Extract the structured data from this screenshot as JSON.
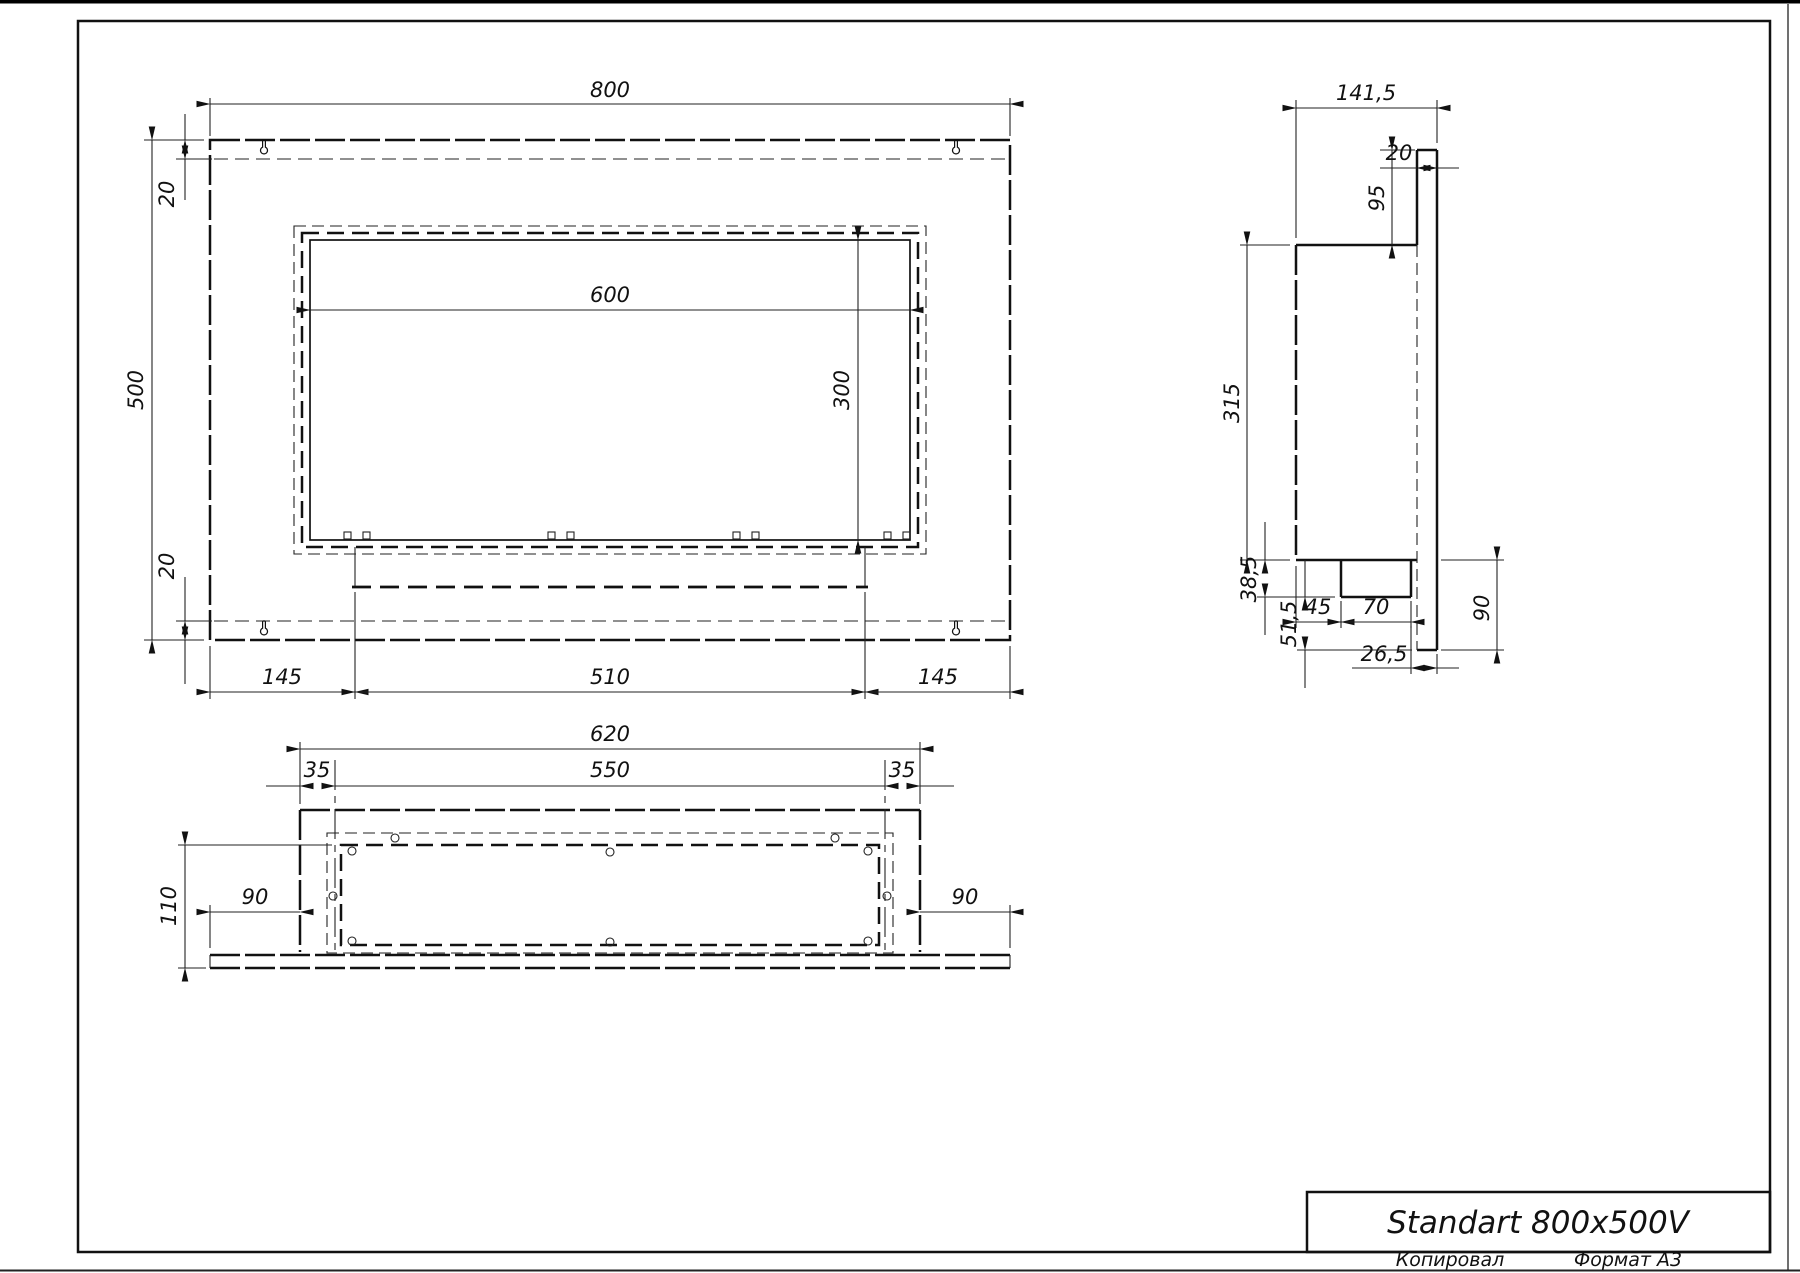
{
  "title_block": {
    "name": "Standart 800x500V"
  },
  "footer": {
    "copied": "Копировал",
    "format": "Формат А3"
  },
  "front_view": {
    "width": "800",
    "height": "500",
    "margin_top": "20",
    "margin_bottom": "20",
    "opening_width": "600",
    "opening_height": "300",
    "bottom_left": "145",
    "bottom_mid": "510",
    "bottom_right": "145"
  },
  "side_view": {
    "depth": "141,5",
    "plate": "20",
    "top_inset": "95",
    "body": "315",
    "tray_drop": "38,5",
    "lower": "51,5",
    "tray_inset": "45",
    "tray_width": "70",
    "bottom_inset": "26,5",
    "lower_total": "90"
  },
  "bottom_view": {
    "width": "620",
    "inset_left": "35",
    "inner": "550",
    "inset_right": "35",
    "depth": "110",
    "overhang_left": "90",
    "overhang_right": "90"
  }
}
